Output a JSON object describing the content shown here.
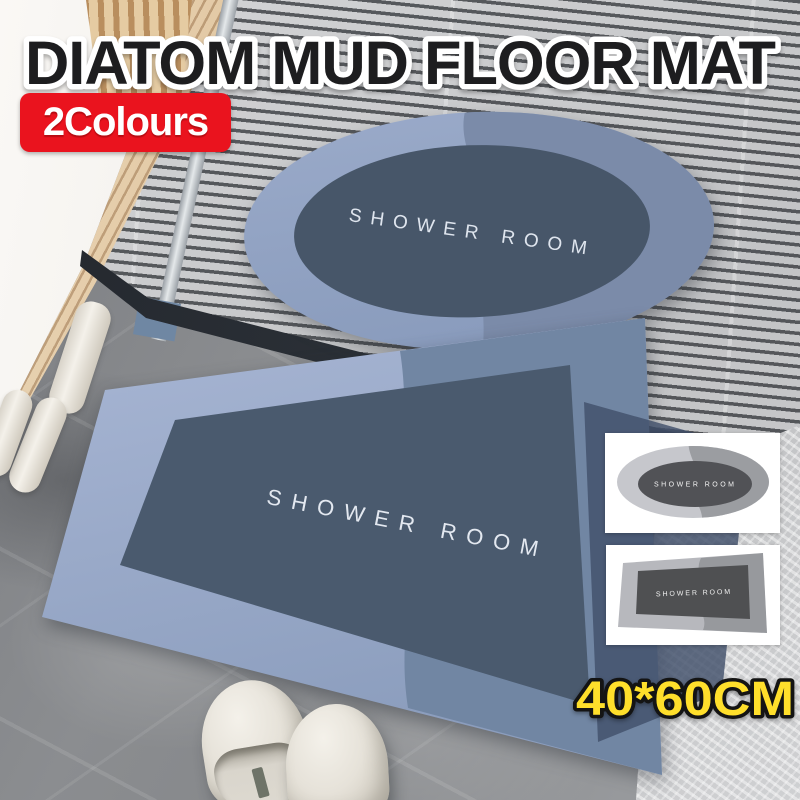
{
  "header": {
    "title": "DIATOM MUD FLOOR MAT",
    "badge": "2Colours"
  },
  "mats": {
    "blue_oval": {
      "shape": "oval",
      "color_name": "blue-grey",
      "text": "SHOWER ROOM"
    },
    "blue_rect": {
      "shape": "rectangle",
      "color_name": "blue-grey",
      "text": "SHOWER ROOM"
    },
    "grey_oval": {
      "shape": "oval",
      "color_name": "grey",
      "text": "SHOWER ROOM"
    },
    "grey_rect": {
      "shape": "rectangle",
      "color_name": "grey",
      "text": "SHOWER ROOM"
    }
  },
  "footer": {
    "size": "40*60CM"
  },
  "colors": {
    "badge_bg": "#ea131e",
    "title_fill": "#1d1d1f",
    "title_stroke": "#ffffff",
    "size_fill": "#ffdf2b",
    "size_stroke": "#141414",
    "blue_mat_border_light": "#9cadcc",
    "blue_mat_border_dark": "#7186a3",
    "blue_mat_center": "#4a5a6e",
    "grey_mat_border_light": "#c6c7cc",
    "grey_mat_border_dark": "#9b9da1",
    "grey_mat_center": "#515256"
  }
}
